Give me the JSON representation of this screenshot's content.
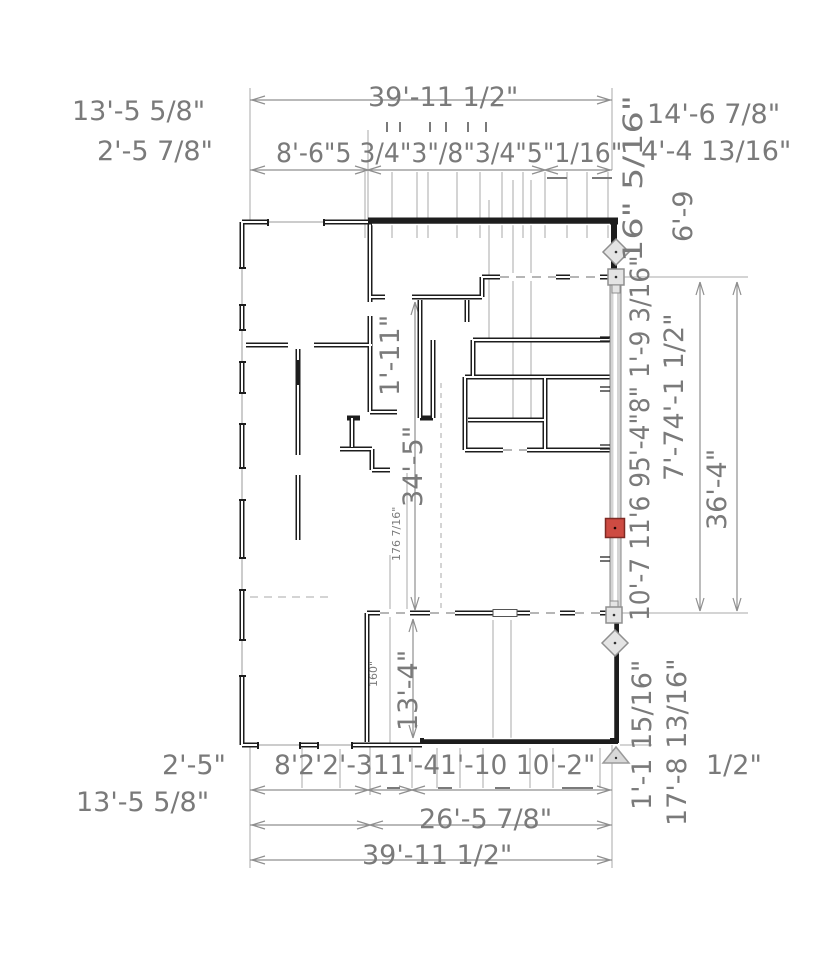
{
  "app": {
    "view": "floor-plan-editor",
    "selection_state": "wall-selected"
  },
  "colors": {
    "dim_text": "#7a7a7a",
    "wall_line": "#1d1d1d",
    "extension_line": "#a8a8a8",
    "dimension_line": "#8f8f8f",
    "selected_wall_fill": "#d4d4d4",
    "handle_fill": "#e4e4e4",
    "handle_border": "#8f8f8f",
    "move_handle_fill": "#cd4b42",
    "move_handle_border": "#7e2a24"
  },
  "dimensions": {
    "top": {
      "total": "39'-11 1/2\"",
      "segments_row": "8'-6\"5 3/4\"3\"/8\"3/4\"5\"1/16\"",
      "left_label_1": "13'-5 5/8\"",
      "left_label_2": "2'-5 7/8\"",
      "right_label_1": "14'-6 7/8\"",
      "right_label_2": "4'-4 13/16\""
    },
    "right": {
      "rotated_upper": "16\" 5/16\"",
      "rotated_upper_2": "6'-9",
      "stack_inner": "10'-7 11'6 95'-4\"8\" 1'-9 3/16\"",
      "stack_mid": "7'-74'-1 1/2\"",
      "total": "36'-4\"",
      "below_1": "1'-1 15/16\"",
      "below_2": "17'-8 13/16\"",
      "below_3": "1/2\""
    },
    "interior": {
      "chase_width": "1'-11\"",
      "vertical_total": "34'-5\"",
      "small_upper": "176 7/16\"",
      "small_lower": "160\"",
      "room_depth": "13'-4\""
    },
    "bottom": {
      "left_label_1": "2'-5\"",
      "left_label_2": "13'-5 5/8\"",
      "segments_row": "8'2'2'-311'-41'-10 10'-2\"",
      "sub_total": "26'-5 7/8\"",
      "total": "39'-11 1/2\""
    }
  },
  "selection": {
    "element": "exterior-wall-right",
    "handles": [
      "rotate-diamond-top",
      "resize-square-top",
      "move-square-red",
      "resize-square-bottom",
      "rotate-diamond-bottom",
      "extend-triangle-bottom"
    ]
  }
}
